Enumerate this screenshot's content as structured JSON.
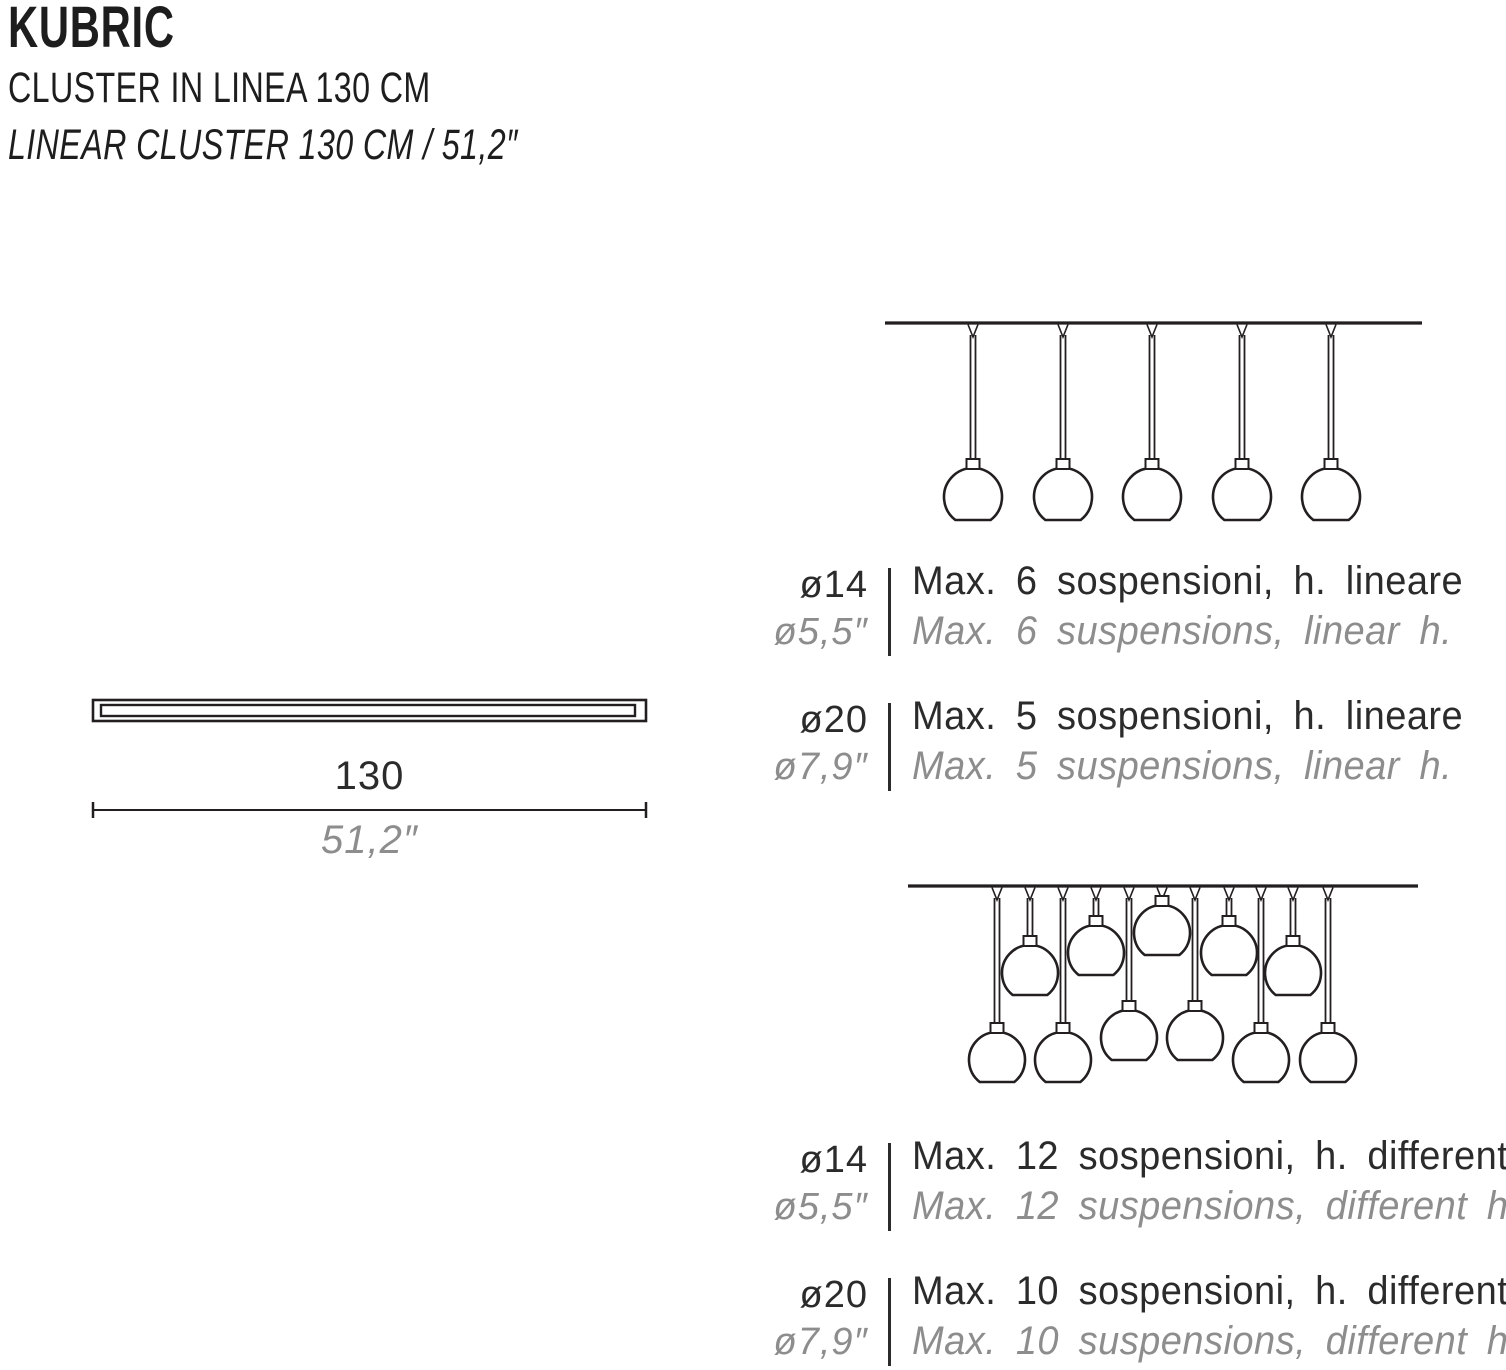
{
  "header": {
    "product_name": "KUBRIC",
    "subtitle_it": "CLUSTER IN LINEA 130 CM",
    "subtitle_en": "LINEAR CLUSTER 130 CM / 51,2″"
  },
  "dimension": {
    "cm": "130",
    "inches": "51,2″"
  },
  "spec_rows": [
    {
      "diameter_cm": "ø14",
      "diameter_in": "ø5,5″",
      "label_it": "Max. 6 sospensioni, h. lineare",
      "label_en": "Max. 6 suspensions, linear h."
    },
    {
      "diameter_cm": "ø20",
      "diameter_in": "ø7,9″",
      "label_it": "Max. 5 sospensioni, h. lineare",
      "label_en": "Max. 5 suspensions, linear h."
    },
    {
      "diameter_cm": "ø14",
      "diameter_in": "ø5,5″",
      "label_it": "Max. 12 sospensioni, h. differenti",
      "label_en": "Max. 12 suspensions, different h."
    },
    {
      "diameter_cm": "ø20",
      "diameter_in": "ø7,9″",
      "label_it": "Max. 10 sospensioni, h. differenti",
      "label_en": "Max. 10 suspensions, different h."
    }
  ],
  "palette": {
    "stroke": "#231f20",
    "text_dark": "#2b2b2b",
    "text_gray": "#8d8d8d",
    "background": "#ffffff"
  },
  "diagrams": {
    "linear_cluster": {
      "pendant_count": 5,
      "ceiling": {
        "x1": 885,
        "x2": 1422,
        "y": 323
      },
      "globe_radius": 29,
      "pendants": [
        {
          "x": 973,
          "cy": 497
        },
        {
          "x": 1063,
          "cy": 497
        },
        {
          "x": 1152,
          "cy": 497
        },
        {
          "x": 1242,
          "cy": 497
        },
        {
          "x": 1331,
          "cy": 497
        }
      ]
    },
    "different_heights_cluster": {
      "pendant_count": 11,
      "ceiling": {
        "x1": 908,
        "x2": 1418,
        "y": 886
      },
      "globe_radius": 28,
      "pendants": [
        {
          "x": 997,
          "cy": 1060
        },
        {
          "x": 1030,
          "cy": 973
        },
        {
          "x": 1063,
          "cy": 1060
        },
        {
          "x": 1096,
          "cy": 953
        },
        {
          "x": 1129,
          "cy": 1038
        },
        {
          "x": 1162,
          "cy": 933
        },
        {
          "x": 1195,
          "cy": 1038
        },
        {
          "x": 1229,
          "cy": 953
        },
        {
          "x": 1261,
          "cy": 1060
        },
        {
          "x": 1293,
          "cy": 973
        },
        {
          "x": 1328,
          "cy": 1060
        }
      ]
    },
    "track_bar": {
      "outer": {
        "x": 93,
        "y": 700,
        "w": 553,
        "h": 21
      },
      "inner": {
        "x": 101,
        "y": 705,
        "w": 534,
        "h": 11
      },
      "dim_line": {
        "x1": 93,
        "x2": 646,
        "y": 810,
        "tick_h": 16
      }
    }
  }
}
